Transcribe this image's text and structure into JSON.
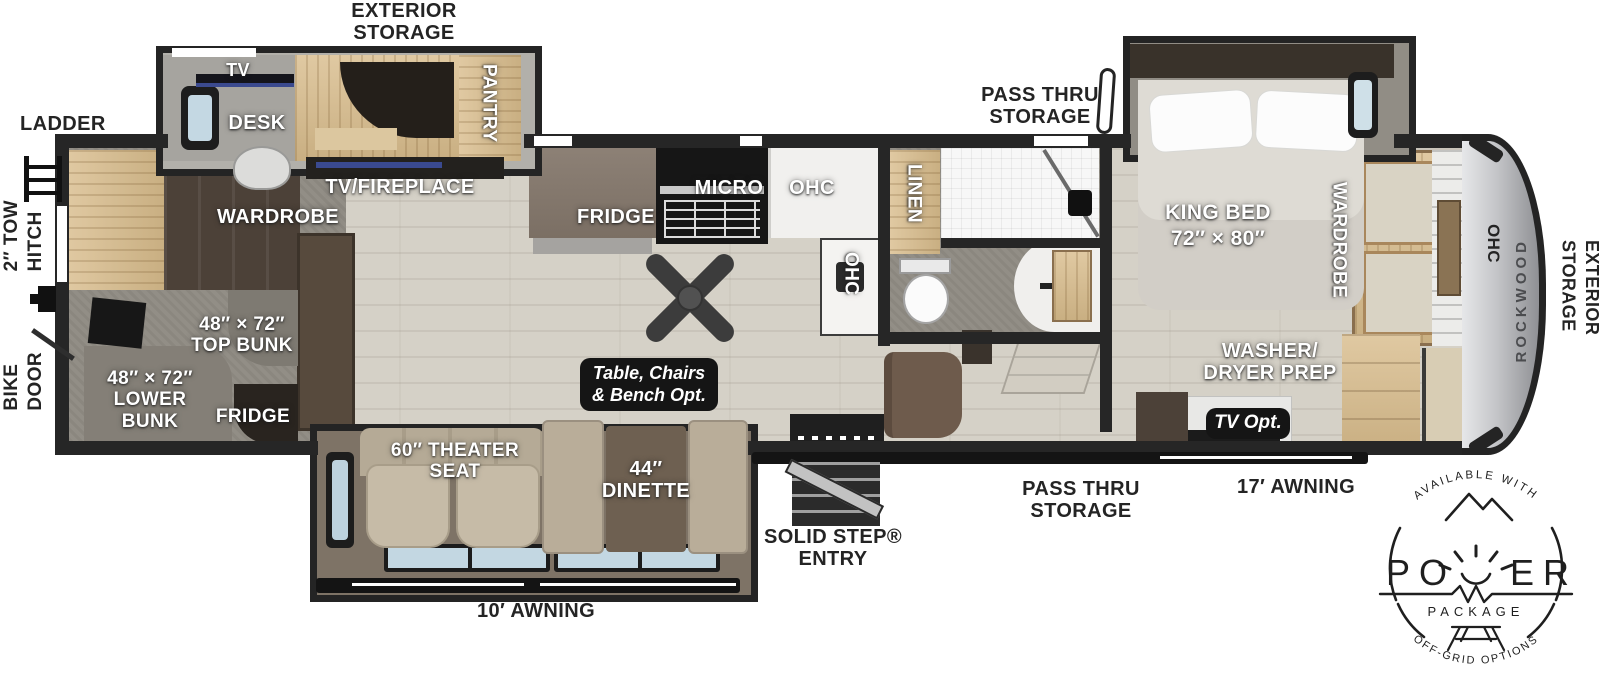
{
  "labels": {
    "exterior_storage_top_1": "EXTERIOR",
    "exterior_storage_top_2": "STORAGE",
    "ladder": "LADDER",
    "tow_hitch_1": "2″ TOW",
    "tow_hitch_2": "HITCH",
    "bike_door_1": "BIKE",
    "bike_door_2": "DOOR",
    "pass_thru_top_1": "PASS THRU",
    "pass_thru_top_2": "STORAGE",
    "tv": "TV",
    "desk": "DESK",
    "pantry": "PANTRY",
    "tv_fireplace": "TV/FIREPLACE",
    "wardrobe_left": "WARDROBE",
    "top_bunk_1": "48″ × 72″",
    "top_bunk_2": "TOP BUNK",
    "lower_bunk_1": "48″ × 72″",
    "lower_bunk_2": "LOWER",
    "lower_bunk_3": "BUNK",
    "fridge_bunk": "FRIDGE",
    "fridge": "FRIDGE",
    "micro": "MICRO",
    "ohc": "OHC",
    "ohc_island": "OHC",
    "linen": "LINEN",
    "king_bed_1": "KING BED",
    "king_bed_2": "72″ × 80″",
    "wardrobe_right": "WARDROBE",
    "ohc_right": "OHC",
    "rockwood": "ROCKWOOD",
    "exterior_storage_right_1": "EXTERIOR",
    "exterior_storage_right_2": "STORAGE",
    "washer_dryer_1": "WASHER/",
    "washer_dryer_2": "DRYER PREP",
    "theater_1": "60″ THEATER",
    "theater_2": "SEAT",
    "dinette_1": "44″",
    "dinette_2": "DINETTE",
    "solid_step_1": "SOLID STEP®",
    "solid_step_2": "ENTRY",
    "pass_thru_bottom_1": "PASS THRU",
    "pass_thru_bottom_2": "STORAGE",
    "awning_17": "17′ AWNING",
    "awning_10": "10′ AWNING"
  },
  "badges": {
    "table_opt_1": "Table, Chairs",
    "table_opt_2": "& Bench Opt.",
    "tv_opt": "TV Opt."
  },
  "logo": {
    "available_with": "AVAILABLE WITH",
    "power_left": "PO",
    "power_right": "ER",
    "package": "PACKAGE",
    "off_grid": "OFF-GRID OPTIONS"
  },
  "colors": {
    "wall": "#262626",
    "floor_wood": "#d5d1c7",
    "carpet": "#928e86",
    "wood_light": "#d9c29c",
    "wood_dark": "#4c4138",
    "awning_bar": "#141414"
  }
}
